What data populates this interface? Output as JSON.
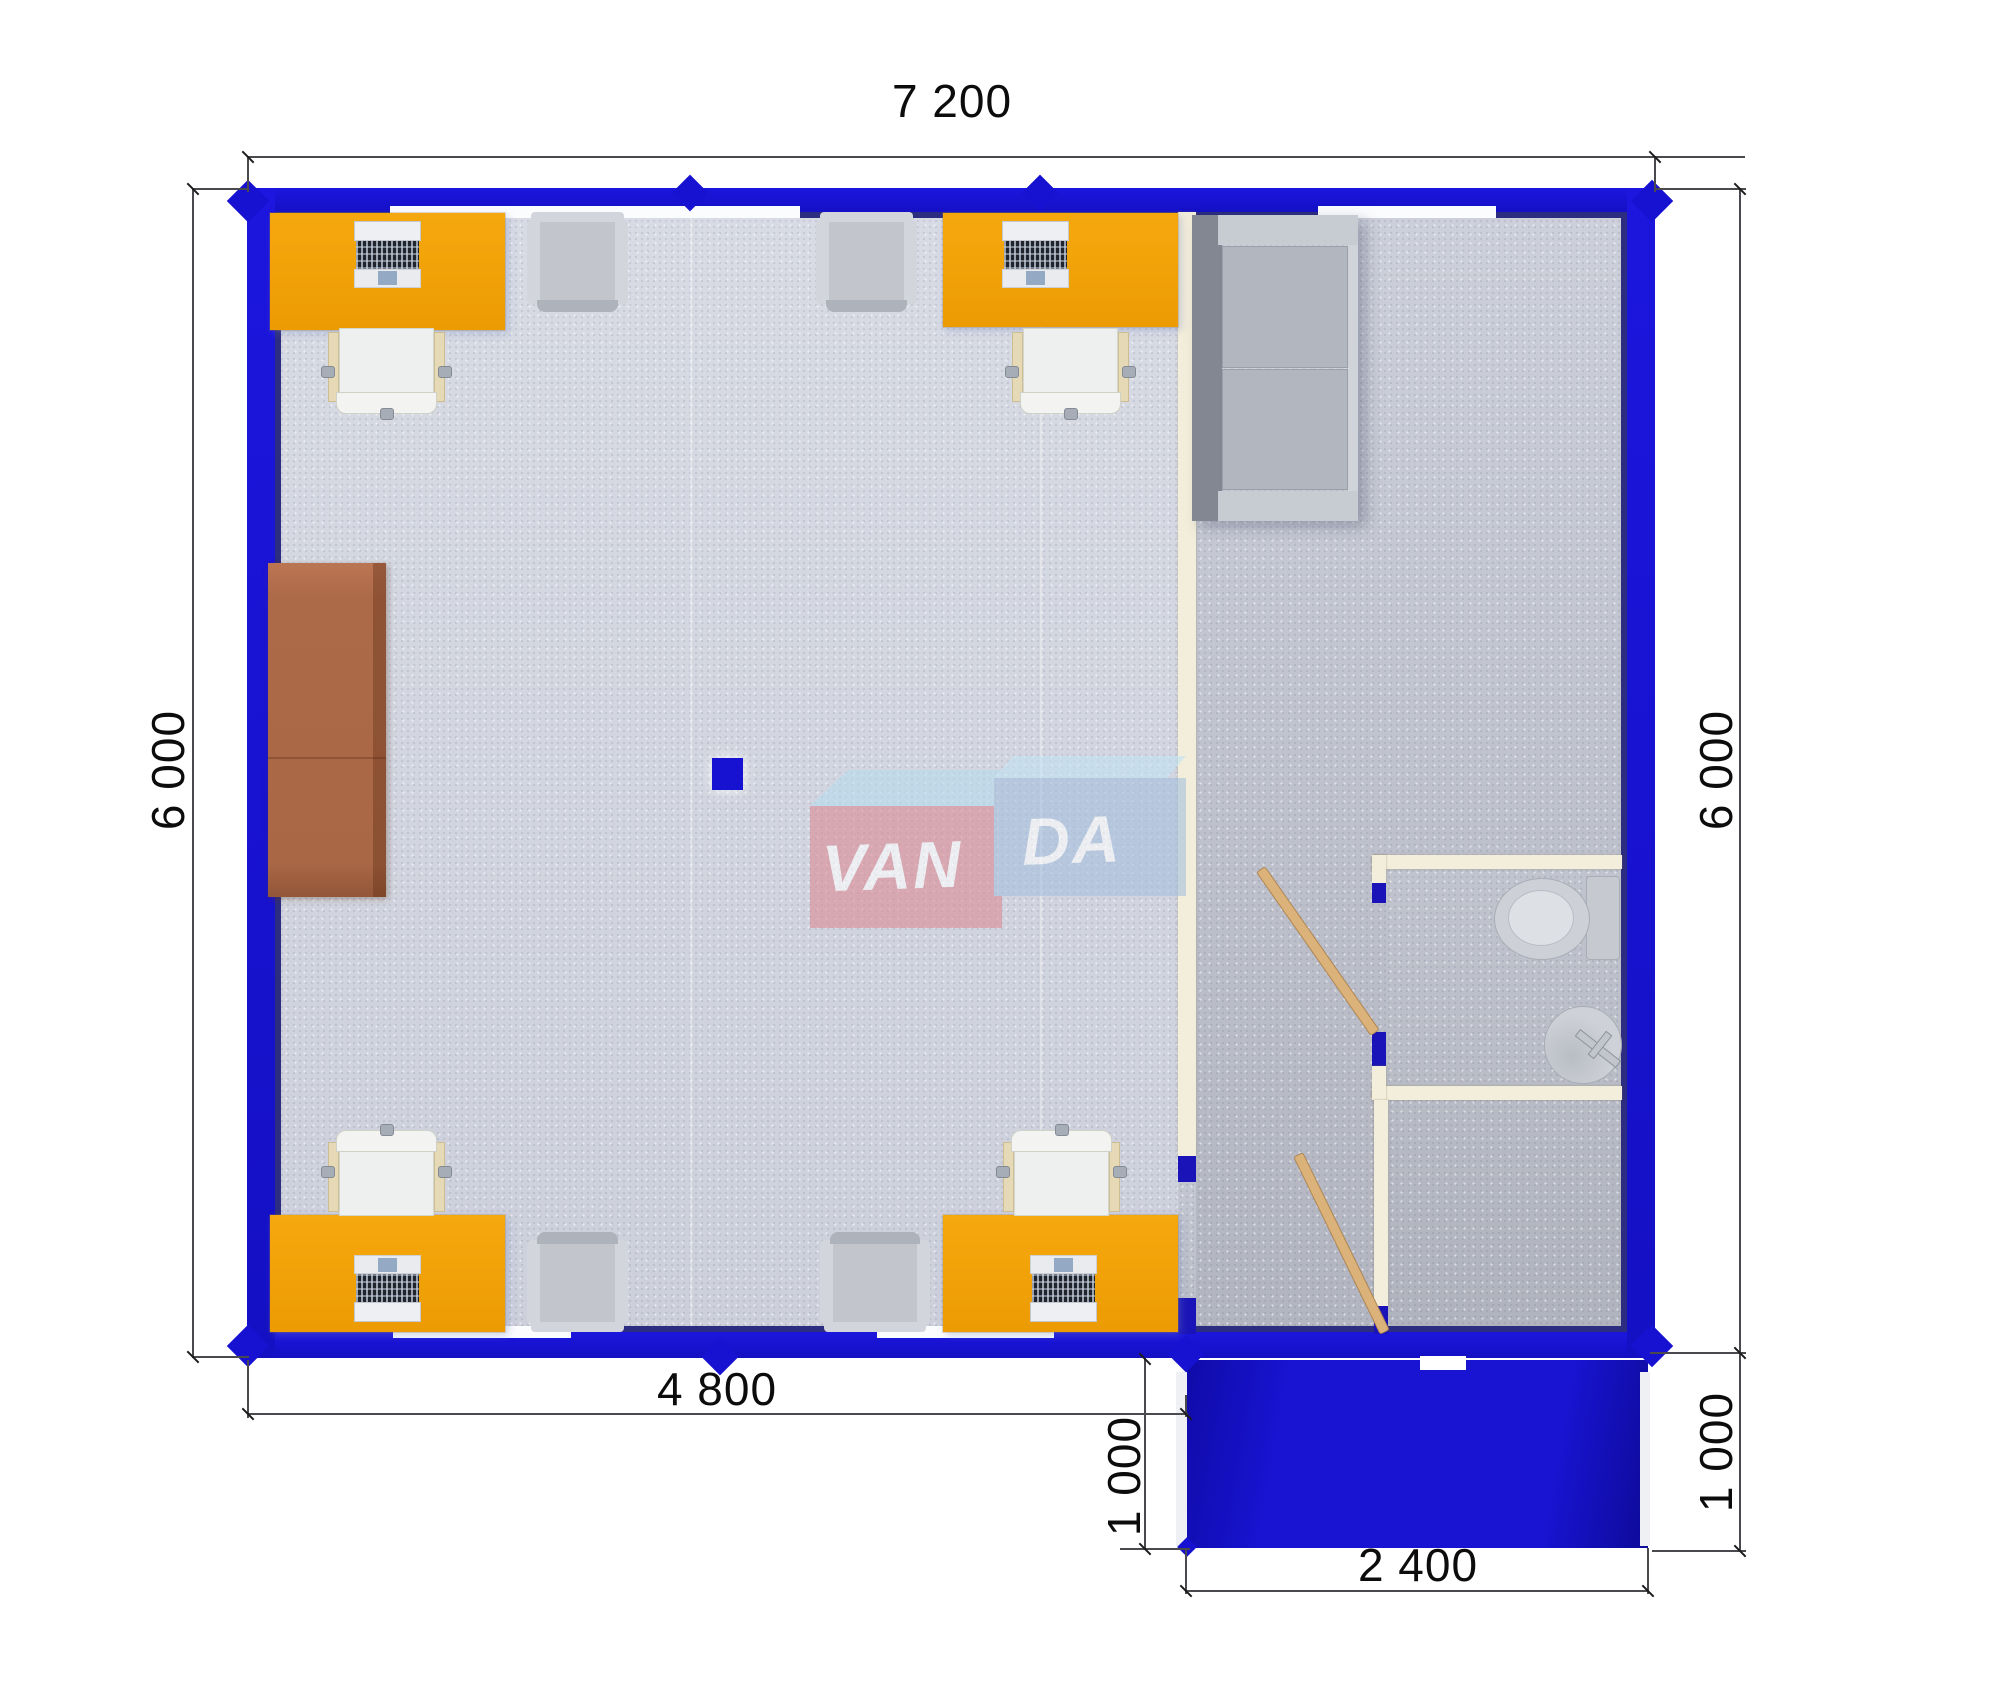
{
  "canvas": {
    "width": 2000,
    "height": 1682,
    "background": "#ffffff"
  },
  "colors": {
    "wall_blue": "#1712d2",
    "wall_inner_shadow": "#2c2c80",
    "porch_blue": "#1310b0",
    "office_floor": "#d8dbe4",
    "hall_floor": "#c7cad4",
    "bathroom_floor": "#bfc2cc",
    "partition_cream": "#f3eedb",
    "desk_orange": "#f0a207",
    "cabinet_brown": "#ad6a49",
    "armchair_gray": "#c9ccd2",
    "sofa_gray": "#b2b6bf",
    "door_wood": "#dcb27b",
    "dimension_text": "#0c0c0c",
    "logo_red": "#dd8b95",
    "logo_blue": "#a6c0de",
    "logo_top": "#bedff0"
  },
  "dimensions": {
    "top_width": "7 200",
    "left_height": "6 000",
    "right_height": "6 000",
    "office_width": "4 800",
    "porch_depth_left": "1 000",
    "porch_depth_right": "1 000",
    "porch_width": "2 400"
  },
  "logo": {
    "left": "VAN",
    "right": "DA"
  }
}
